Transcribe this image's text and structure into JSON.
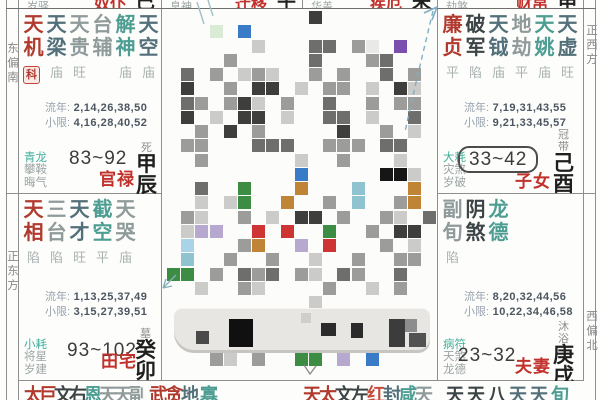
{
  "edges": {
    "left_top": "东偏南",
    "left_bottom": "正东方",
    "right_top": "正西方",
    "right_bottom": "西偏北"
  },
  "colors": {
    "red": "#b03a2e",
    "red2": "#c84b3c",
    "dark": "#3c4446",
    "slate": "#53707a",
    "gray": "#8f9a9a",
    "teal": "#4d9d92"
  },
  "palaces": [
    {
      "key": "guanlu",
      "pos": "l1",
      "stars": {
        "names": [
          "天机",
          "天梁",
          "天贵",
          "台辅",
          "解神",
          "天空"
        ],
        "colors": [
          "red",
          "slate",
          "gray",
          "gray",
          "teal",
          "slate"
        ],
        "statuses": [
          "利",
          "庙",
          "旺",
          "",
          "庙",
          "庙"
        ]
      },
      "badge": "科",
      "ln_label": "流年:",
      "ln": "2,14,26,38,50",
      "xx_label": "小限:",
      "xx": "4,16,28,40,52",
      "shensha": [
        "青龙",
        "攀鞍",
        "晦气"
      ],
      "decade": "83~92",
      "decade_boxed": false,
      "name": "官禄",
      "stage": "死",
      "ganzhi": [
        "甲",
        "辰"
      ]
    },
    {
      "key": "tianzhai",
      "pos": "l2",
      "stars": {
        "names": [
          "天相",
          "三台",
          "天才",
          "截空",
          "天哭"
        ],
        "colors": [
          "red",
          "gray",
          "slate",
          "teal",
          "gray"
        ],
        "statuses": [
          "陷",
          "陷",
          "旺",
          "平",
          "庙"
        ]
      },
      "ln_label": "流年:",
      "ln": "1,13,25,37,49",
      "xx_label": "小限:",
      "xx": "3,15,27,39,51",
      "shensha": [
        "小耗",
        "将星",
        "岁建"
      ],
      "decade": "93~102",
      "decade_boxed": false,
      "name": "田宅",
      "stage": "墓",
      "ganzhi": [
        "癸",
        "卯"
      ]
    },
    {
      "key": "zinv",
      "pos": "r1",
      "stars": {
        "names": [
          "廉贞",
          "破军",
          "天钺",
          "地劫",
          "天姚",
          "天虚"
        ],
        "colors": [
          "red",
          "dark",
          "slate",
          "gray",
          "teal",
          "slate"
        ],
        "statuses": [
          "平",
          "陷",
          "庙",
          "平",
          "庙",
          "旺"
        ]
      },
      "ln_label": "流年:",
      "ln": "7,19,31,43,55",
      "xx_label": "小限:",
      "xx": "9,21,33,45,57",
      "shensha": [
        "大耗",
        "灾煞",
        "岁破"
      ],
      "decade": "33~42",
      "decade_boxed": true,
      "name": "子女",
      "stage": "冠带",
      "ganzhi": [
        "己",
        "酉"
      ]
    },
    {
      "key": "fuqi",
      "pos": "r2",
      "stars": {
        "names": [
          "副旬",
          "阴煞",
          "龙德"
        ],
        "colors": [
          "gray",
          "dark",
          "teal"
        ],
        "statuses": [
          "陷",
          "",
          ""
        ]
      },
      "ln_label": "流年:",
      "ln": "8,20,32,44,56",
      "xx_label": "小限:",
      "xx": "10,22,34,46,58",
      "shensha": [
        "病符",
        "天煞",
        "龙德"
      ],
      "decade": "23~32",
      "decade_boxed": false,
      "name": "夫妻",
      "stage": "沐浴",
      "ganzhi": [
        "庚",
        "戌"
      ]
    }
  ],
  "top_row": [
    {
      "side": "岁驿",
      "label": "奴仆",
      "branch": "巳"
    },
    {
      "side": "息神",
      "label": "迁移",
      "branch": "午"
    },
    {
      "side": "华盖",
      "label": "疾厄",
      "branch": "未"
    },
    {
      "side": "劫煞",
      "label": "财帛",
      "branch": "申"
    }
  ],
  "bottom_row": [
    {
      "chars": [
        [
          "太",
          "red"
        ],
        [
          "巨",
          "red"
        ],
        [
          "文",
          "dark"
        ],
        [
          "右",
          "dark"
        ],
        [
          "恩",
          "teal"
        ],
        [
          "天",
          "gray"
        ],
        [
          "天",
          "gray"
        ],
        [
          "副",
          "gray"
        ]
      ]
    },
    {
      "chars": [
        [
          "武",
          "red"
        ],
        [
          "贪",
          "red"
        ],
        [
          "地",
          "slate"
        ],
        [
          " ",
          ""
        ],
        [
          "寡",
          "teal"
        ]
      ]
    },
    {
      "chars": [
        [
          "天",
          "red"
        ],
        [
          "太",
          "red"
        ],
        [
          "文",
          "dark"
        ],
        [
          "左",
          "dark"
        ],
        [
          "红",
          "red2"
        ],
        [
          "封",
          "slate"
        ],
        [
          "咸",
          "teal"
        ],
        [
          "天",
          "gray"
        ]
      ]
    },
    {
      "chars": [
        [
          "天",
          "dark"
        ],
        [
          "天",
          "dark"
        ],
        [
          "八",
          "dark"
        ],
        [
          "天",
          "slate"
        ],
        [
          "天",
          "slate"
        ],
        [
          "旬",
          "teal"
        ]
      ]
    }
  ],
  "mosaic": {
    "palette": {
      "a": "#e9e9e7",
      "b": "#cbcbc9",
      "c": "#9c9c9a",
      "d": "#6e6e6c",
      "e": "#3e3e3c",
      "k": "#161616",
      "g": "#3d8c44",
      "l": "#d9ead5",
      "u": "#3a7bc8",
      "p": "#7b4fae",
      "m": "#b7a8cf",
      "o": "#bf8436",
      "t": "#8fc3cf",
      "r": "#cf3434",
      "A": "#a9d3e6"
    },
    "rows": [
      "..........e........",
      "...l.u.............",
      "......b...dd.ca.p..",
      "....c.....d...cd...",
      ".d.c.bcb..c.c..d.c.",
      ".e..c.ee.b.cc.b.eb.",
      ".dc.ceb.c..d..c.cc.",
      ".e.b.ee.b..dd.b..d.",
      "..c.e.c.....e..c.b.",
      ".cc...ddd..ccc.dd..",
      "..c......b..c...b..",
      ".........u.....kkb.",
      "..d..g...o...t...o.",
      "..b.bg..o..c.t..co.",
      ".cb..c.b.ee.c..cb.d",
      ".bmm..r.r..g..c.ee.",
      ".A...co..m.r...c.b.",
      ".t..c..c..b..c..cc.",
      "gg.c.dcd.cb.dc..d..",
      "..b..cb....c..b.c..",
      "..........b........",
      "...................",
      "...................",
      "...................",
      "...cb.c..gg.m.u....",
      "..................."
    ]
  },
  "bar_blocks": [
    [
      22,
      23,
      13,
      13,
      "#4a4a4a"
    ],
    [
      55,
      11,
      24,
      28,
      "#101010"
    ],
    [
      127,
      5,
      10,
      10,
      "#cfcecb"
    ],
    [
      147,
      15,
      15,
      13,
      "#2b2b2b"
    ],
    [
      177,
      15,
      12,
      15,
      "#2b2b2b"
    ],
    [
      215,
      11,
      16,
      28,
      "#3c3c3c"
    ],
    [
      231,
      11,
      12,
      13,
      "#8d8d8d"
    ],
    [
      235,
      25,
      17,
      14,
      "#525252"
    ]
  ],
  "annotations": {
    "items": [
      "top-center-strokes",
      "top-right-dashed-arrow",
      "left-mid-arrow",
      "bottom-mid-caret"
    ],
    "teal": "#7fafc4",
    "gray": "#8a8a8a"
  }
}
